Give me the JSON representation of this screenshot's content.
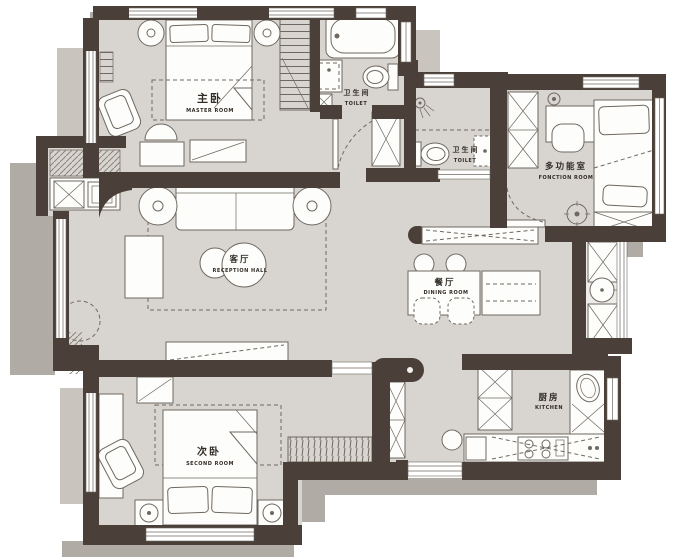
{
  "plan": {
    "type": "apartment-floor-plan",
    "rooms": [
      {
        "key": "master-room",
        "zh": "主卧",
        "en": "MASTER ROOM"
      },
      {
        "key": "bath-main",
        "zh": "卫生间",
        "en": "TOILET"
      },
      {
        "key": "bath-guest",
        "zh": "卫生间",
        "en": "TOILET"
      },
      {
        "key": "function-room",
        "zh": "多功能室",
        "en": "FONCTION ROOM"
      },
      {
        "key": "reception-hall",
        "zh": "客厅",
        "en": "RECEPTION HALL"
      },
      {
        "key": "dining-room",
        "zh": "餐厅",
        "en": "DINING ROOM"
      },
      {
        "key": "second-room",
        "zh": "次卧",
        "en": "SECOND ROOM"
      },
      {
        "key": "kitchen",
        "zh": "厨房",
        "en": "KITCHEN"
      }
    ],
    "colors": {
      "bg": "#ffffff",
      "wall": "#4a4039",
      "floor": "#d8d5d0",
      "balcony": "#edecea",
      "furn": "#fdfdfb",
      "line": "#6f6860",
      "shadow": "#b1aba5",
      "shadow-light": "#c9c4be",
      "ink": "#322c26"
    }
  }
}
